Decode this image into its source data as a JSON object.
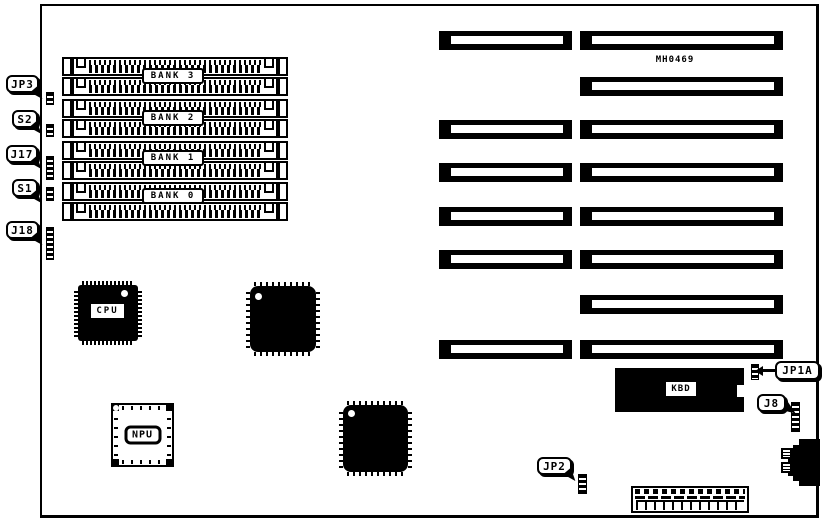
{
  "board": {
    "part_number": "MH0469"
  },
  "memory": {
    "bank3": "BANK 3",
    "bank2": "BANK 2",
    "bank1": "BANK 1",
    "bank0": "BANK 0"
  },
  "chips": {
    "cpu": "CPU",
    "npu": "NPU",
    "kbd": "KBD"
  },
  "callouts": {
    "jp3": "JP3",
    "s2": "S2",
    "j17": "J17",
    "s1": "S1",
    "j18": "J18",
    "jp1a": "JP1A",
    "j8": "J8",
    "jp2": "JP2"
  },
  "colors": {
    "ink": "#000000",
    "paper": "#ffffff"
  }
}
